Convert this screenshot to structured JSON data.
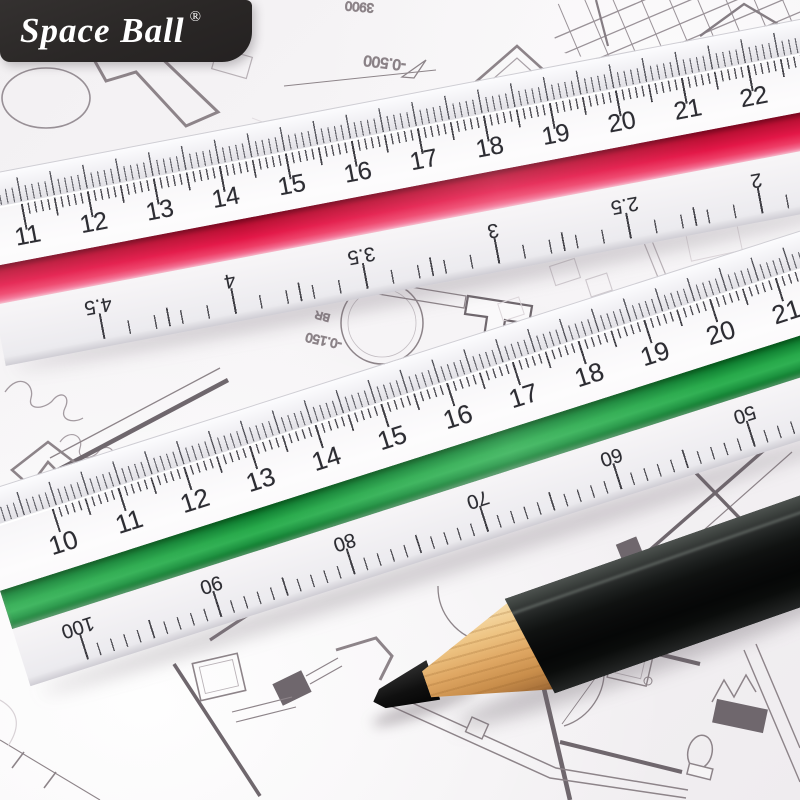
{
  "brand": {
    "name": "Space Ball",
    "registered": "®",
    "banner_color": "#2a2726",
    "text_color": "#ffffff"
  },
  "rulers": {
    "red": {
      "stripe_color": "#e31747",
      "top_scale": [
        "11",
        "12",
        "13",
        "14",
        "15",
        "16",
        "17",
        "18",
        "19",
        "20",
        "21",
        "22"
      ],
      "bottom_scale": [
        "4.5",
        "4",
        "3.5",
        "3",
        "2.5",
        "2"
      ]
    },
    "green": {
      "stripe_color": "#27a94a",
      "top_scale": [
        "10",
        "11",
        "12",
        "13",
        "14",
        "15",
        "16",
        "17",
        "18",
        "19",
        "20",
        "21"
      ],
      "bottom_scale": [
        "100",
        "90",
        "80",
        "70",
        "60",
        "50"
      ]
    }
  },
  "blueprint": {
    "line_color": "#8d8489",
    "wall_color": "#6f676d",
    "annotations": {
      "elevation_top": "-0.500",
      "elevation_mid": "-0.150",
      "room_label": "BR",
      "dimension": "3900"
    }
  },
  "pencil": {
    "body_color": "#0a0b0b",
    "wood_color": "#dfa763",
    "lead_color": "#101010"
  }
}
